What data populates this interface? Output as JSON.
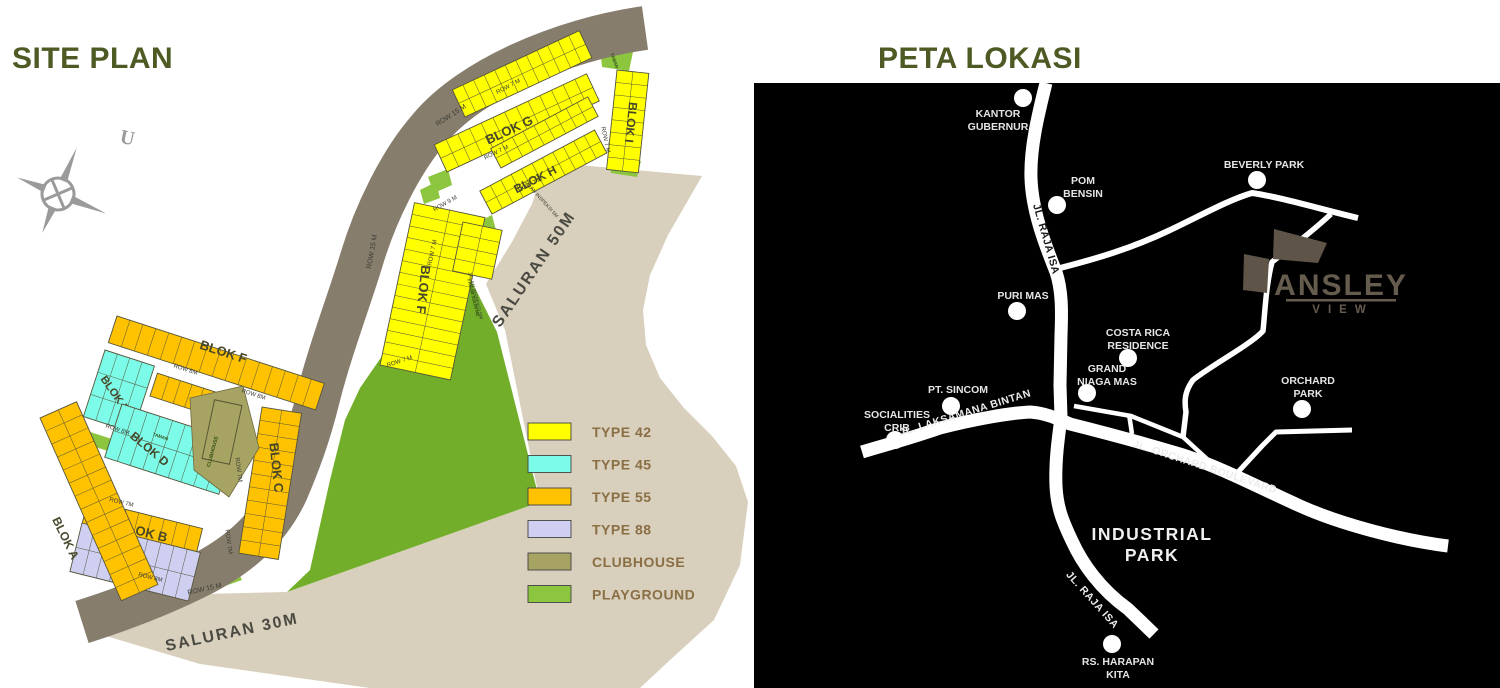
{
  "site_plan": {
    "title": "SITE PLAN",
    "compass_letter": "U",
    "legend": {
      "items": [
        {
          "label": "TYPE 42",
          "color": "#FFFF00"
        },
        {
          "label": "TYPE 45",
          "color": "#7DFBE9"
        },
        {
          "label": "TYPE 55",
          "color": "#FFC200"
        },
        {
          "label": "TYPE 88",
          "color": "#CFCFF2"
        },
        {
          "label": "CLUBHOUSE",
          "color": "#A6A363"
        },
        {
          "label": "PLAYGROUND",
          "color": "#8CC63F"
        }
      ]
    },
    "colors": {
      "canal": "#D8CFBC",
      "road_band": "#877D6D",
      "field_green": "#72AE2A",
      "accent_green": "#8CC63F",
      "plot_stroke": "#55553A"
    },
    "blocks": [
      {
        "name": "BLOK G",
        "color": "#FFFF00",
        "strips": [
          [
            447,
            172,
            -25,
            168,
            -30,
            13,
            2
          ],
          [
            465,
            117,
            -25,
            140,
            -30,
            12,
            2
          ]
        ],
        "label": [
          511,
          134,
          -25,
          13
        ]
      },
      {
        "name": "BLOK H",
        "color": "#FFFF00",
        "strips": [
          [
            492,
            214,
            -28,
            130,
            -26,
            11,
            2
          ],
          [
            501,
            168,
            -28,
            110,
            -22,
            9,
            2
          ]
        ],
        "label": [
          537,
          183,
          -27,
          12
        ]
      },
      {
        "name": "BLOK I",
        "color": "#FFFF00",
        "strips": [
          [
            617,
            70,
            96,
            100,
            -32,
            8,
            2
          ]
        ],
        "label": [
          627,
          122,
          96,
          12
        ]
      },
      {
        "name": "BLOK F",
        "color": "#FFFF00",
        "strips": [
          [
            380,
            365,
            -78,
            166,
            72,
            14,
            2
          ],
          [
            463,
            222,
            102,
            50,
            -40,
            4,
            2
          ]
        ],
        "label": [
          419,
          289,
          96,
          13
        ]
      },
      {
        "name": "BLOK F",
        "color": "#FFC200",
        "strips": [
          [
            117,
            316,
            18,
            218,
            28,
            16,
            1
          ]
        ],
        "label": [
          222,
          356,
          18,
          13
        ]
      },
      {
        "name": "BLOK E",
        "color": "#7DFBE9",
        "strips": [
          [
            105,
            350,
            18,
            52,
            70,
            4,
            3
          ]
        ],
        "label": [
          112,
          396,
          55,
          11
        ]
      },
      {
        "name": "BLOK D",
        "color": "#7DFBE9",
        "strips": [
          [
            122,
            404,
            18,
            120,
            56,
            9,
            2
          ]
        ],
        "label": [
          147,
          452,
          40,
          12
        ]
      },
      {
        "name": "",
        "color": "#FFC200",
        "strips": [
          [
            150,
            396,
            18,
            85,
            -24,
            7,
            1
          ]
        ],
        "label": null
      },
      {
        "name": "BLOK C",
        "color": "#FFC200",
        "strips": [
          [
            262,
            407,
            99,
            148,
            -40,
            11,
            2
          ]
        ],
        "label": [
          272,
          468,
          84,
          13
        ]
      },
      {
        "name": "BLOK B",
        "color": "#FFC200",
        "strips": [
          [
            88,
            500,
            14,
            118,
            24,
            9,
            1
          ]
        ],
        "label": [
          142,
          536,
          14,
          13
        ]
      },
      {
        "name": "",
        "color": "#CFCFF2",
        "strips": [
          [
            82,
            523,
            14,
            122,
            50,
            9,
            2
          ]
        ],
        "label": null
      },
      {
        "name": "BLOK A",
        "color": "#FFC200",
        "strips": [
          [
            40,
            418,
            66,
            200,
            -40,
            14,
            2
          ]
        ],
        "label": [
          62,
          540,
          64,
          12
        ]
      }
    ],
    "clubhouse": {
      "label": "CLUBHOUSE",
      "color": "#A6A363",
      "poly": [
        [
          190,
          398
        ],
        [
          243,
          386
        ],
        [
          259,
          448
        ],
        [
          229,
          497
        ],
        [
          194,
          470
        ]
      ],
      "label_pos": [
        214,
        452,
        -75,
        5
      ]
    },
    "road_labels": [
      [
        "ROW 15 M",
        452,
        117,
        -33,
        7
      ],
      [
        "ROW 15 M",
        374,
        252,
        -80,
        7
      ],
      [
        "ROW 15 M",
        205,
        591,
        -13,
        7
      ],
      [
        "ROW 7 M",
        509,
        88,
        -28,
        6
      ],
      [
        "ROW 7 M",
        497,
        154,
        -26,
        6
      ],
      [
        "ROW 7 M",
        531,
        186,
        -27,
        6
      ],
      [
        "ROW 7 M",
        604,
        140,
        78,
        6
      ],
      [
        "ROW 7 M",
        434,
        253,
        -78,
        6
      ],
      [
        "ROW 7 M",
        400,
        363,
        -18,
        6
      ],
      [
        "ROW 9 M",
        446,
        205,
        -30,
        6
      ],
      [
        "JALAN INSPEKSI 5M",
        540,
        200,
        48,
        5
      ],
      [
        "JALAN INSPEKSI 5M",
        474,
        296,
        76,
        5
      ],
      [
        "ROW 8M",
        185,
        371,
        18,
        6
      ],
      [
        "ROW 8M",
        253,
        396,
        18,
        6
      ],
      [
        "ROW 8M",
        117,
        431,
        18,
        6
      ],
      [
        "ROW 7M",
        121,
        504,
        14,
        6
      ],
      [
        "ROW 8M",
        150,
        579,
        14,
        6
      ],
      [
        "ROW 7M",
        227,
        542,
        82,
        6
      ],
      [
        "ROW 7M",
        237,
        470,
        82,
        6
      ]
    ],
    "saluran_labels": [
      [
        "SALURAN 50M",
        538,
        272,
        -56,
        16
      ],
      [
        "SALURAN 30M",
        233,
        637,
        -12,
        16
      ]
    ],
    "area_labels": [
      [
        "FASUM 518.09 M2",
        472,
        298,
        76,
        4.5
      ],
      [
        "TAMAN",
        613,
        61,
        70,
        4.5
      ],
      [
        "TAMAN",
        160,
        438,
        18,
        4.5
      ]
    ]
  },
  "location_map": {
    "title": "PETA LOKASI",
    "colors": {
      "bg": "#000000",
      "road": "#FFFFFF",
      "label": "#E5E5E5",
      "site": "#5E5447",
      "logo": "#665C4E"
    },
    "logo": {
      "name": "ANSLEY",
      "sub": "VIEW"
    },
    "points": [
      {
        "lines": [
          "KANTOR",
          "GUBERNUR"
        ],
        "x": 998,
        "y": 117,
        "dot": [
          1023,
          98
        ]
      },
      {
        "lines": [
          "POM",
          "BENSIN"
        ],
        "x": 1083,
        "y": 184,
        "dot": [
          1057,
          205
        ]
      },
      {
        "lines": [
          "BEVERLY PARK"
        ],
        "x": 1264,
        "y": 168,
        "dot": [
          1257,
          180
        ]
      },
      {
        "lines": [
          "PURI MAS"
        ],
        "x": 1023,
        "y": 299,
        "dot": [
          1017,
          311
        ]
      },
      {
        "lines": [
          "COSTA RICA",
          "RESIDENCE"
        ],
        "x": 1138,
        "y": 336,
        "dot": [
          1128,
          358
        ]
      },
      {
        "lines": [
          "GRAND",
          "NIAGA MAS"
        ],
        "x": 1107,
        "y": 372,
        "dot": [
          1087,
          393
        ]
      },
      {
        "lines": [
          "PT. SINCOM"
        ],
        "x": 958,
        "y": 393,
        "dot": [
          951,
          406
        ]
      },
      {
        "lines": [
          "SOCIALITIES",
          "CRIB"
        ],
        "x": 897,
        "y": 418,
        "dot": [
          895,
          440
        ]
      },
      {
        "lines": [
          "ORCHARD",
          "PARK"
        ],
        "x": 1308,
        "y": 384,
        "dot": [
          1302,
          409
        ]
      },
      {
        "lines": [
          "RS. HARAPAN",
          "KITA"
        ],
        "x": 1118,
        "y": 665,
        "dot": [
          1112,
          644
        ]
      }
    ],
    "road_names": [
      {
        "text": "JL. RAJA ISA",
        "x": 1043,
        "y": 240,
        "rot": 74,
        "dark": true
      },
      {
        "text": "JL. RAJA ISA",
        "x": 1090,
        "y": 602,
        "rot": 48,
        "dark": false
      },
      {
        "text": "JL. LAKSAMANA BINTAN",
        "x": 966,
        "y": 416,
        "rot": -17,
        "dark": false
      },
      {
        "text": "JL. ORCHARD BOULEVARD",
        "x": 1204,
        "y": 470,
        "rot": 18,
        "dark": false
      }
    ],
    "area_labels": [
      {
        "lines": [
          "INDUSTRIAL",
          "PARK"
        ],
        "x": 1152,
        "y": 540
      }
    ]
  }
}
